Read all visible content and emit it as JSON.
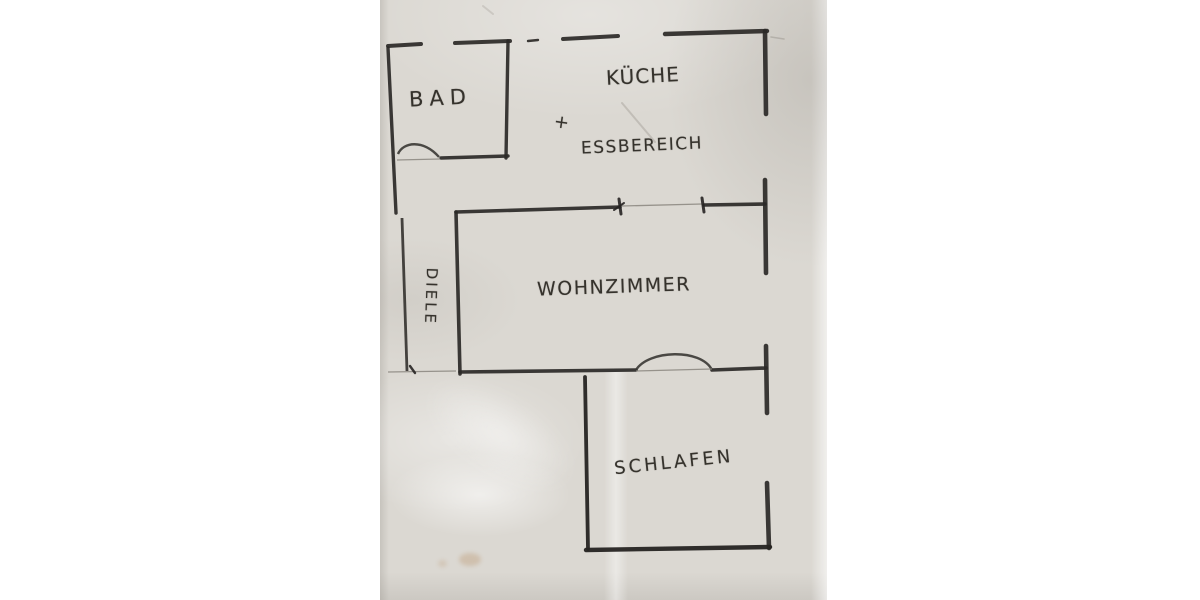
{
  "floorplan": {
    "labels": {
      "bad": "BAD",
      "kueche": "KÜCHE",
      "plus": "+",
      "essbereich": "ESSBEREICH",
      "wohnzimmer": "WOHNZIMMER",
      "diele": "DIELE",
      "schlafen": "SCHLAFEN"
    },
    "colors": {
      "background": "#ffffff",
      "paper": "#dbd8d2",
      "ink": "#2b2927",
      "thin_line": "#8a867f",
      "stain": "#b5895a"
    }
  }
}
